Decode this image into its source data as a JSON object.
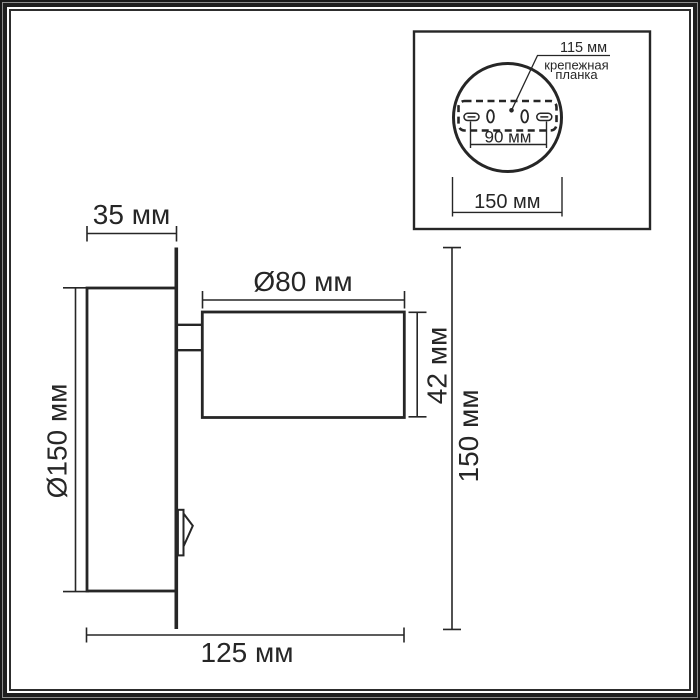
{
  "main_view": {
    "plate_depth": "35 мм",
    "head_diameter": "Ø80 мм",
    "head_length": "42 мм",
    "base_diameter": "Ø150 мм",
    "overall_height": "150 мм",
    "overall_width": "125 мм"
  },
  "inset_view": {
    "plate_width": "115 мм",
    "plate_name_line1": "крепежная",
    "plate_name_line2": "планка",
    "slot_spacing": "90 мм",
    "plate_diameter": "150 мм"
  },
  "colors": {
    "line": "#262626",
    "frame_dark": "#1a1a1a",
    "frame_gray": "#8f8f8f",
    "background": "#ffffff"
  }
}
